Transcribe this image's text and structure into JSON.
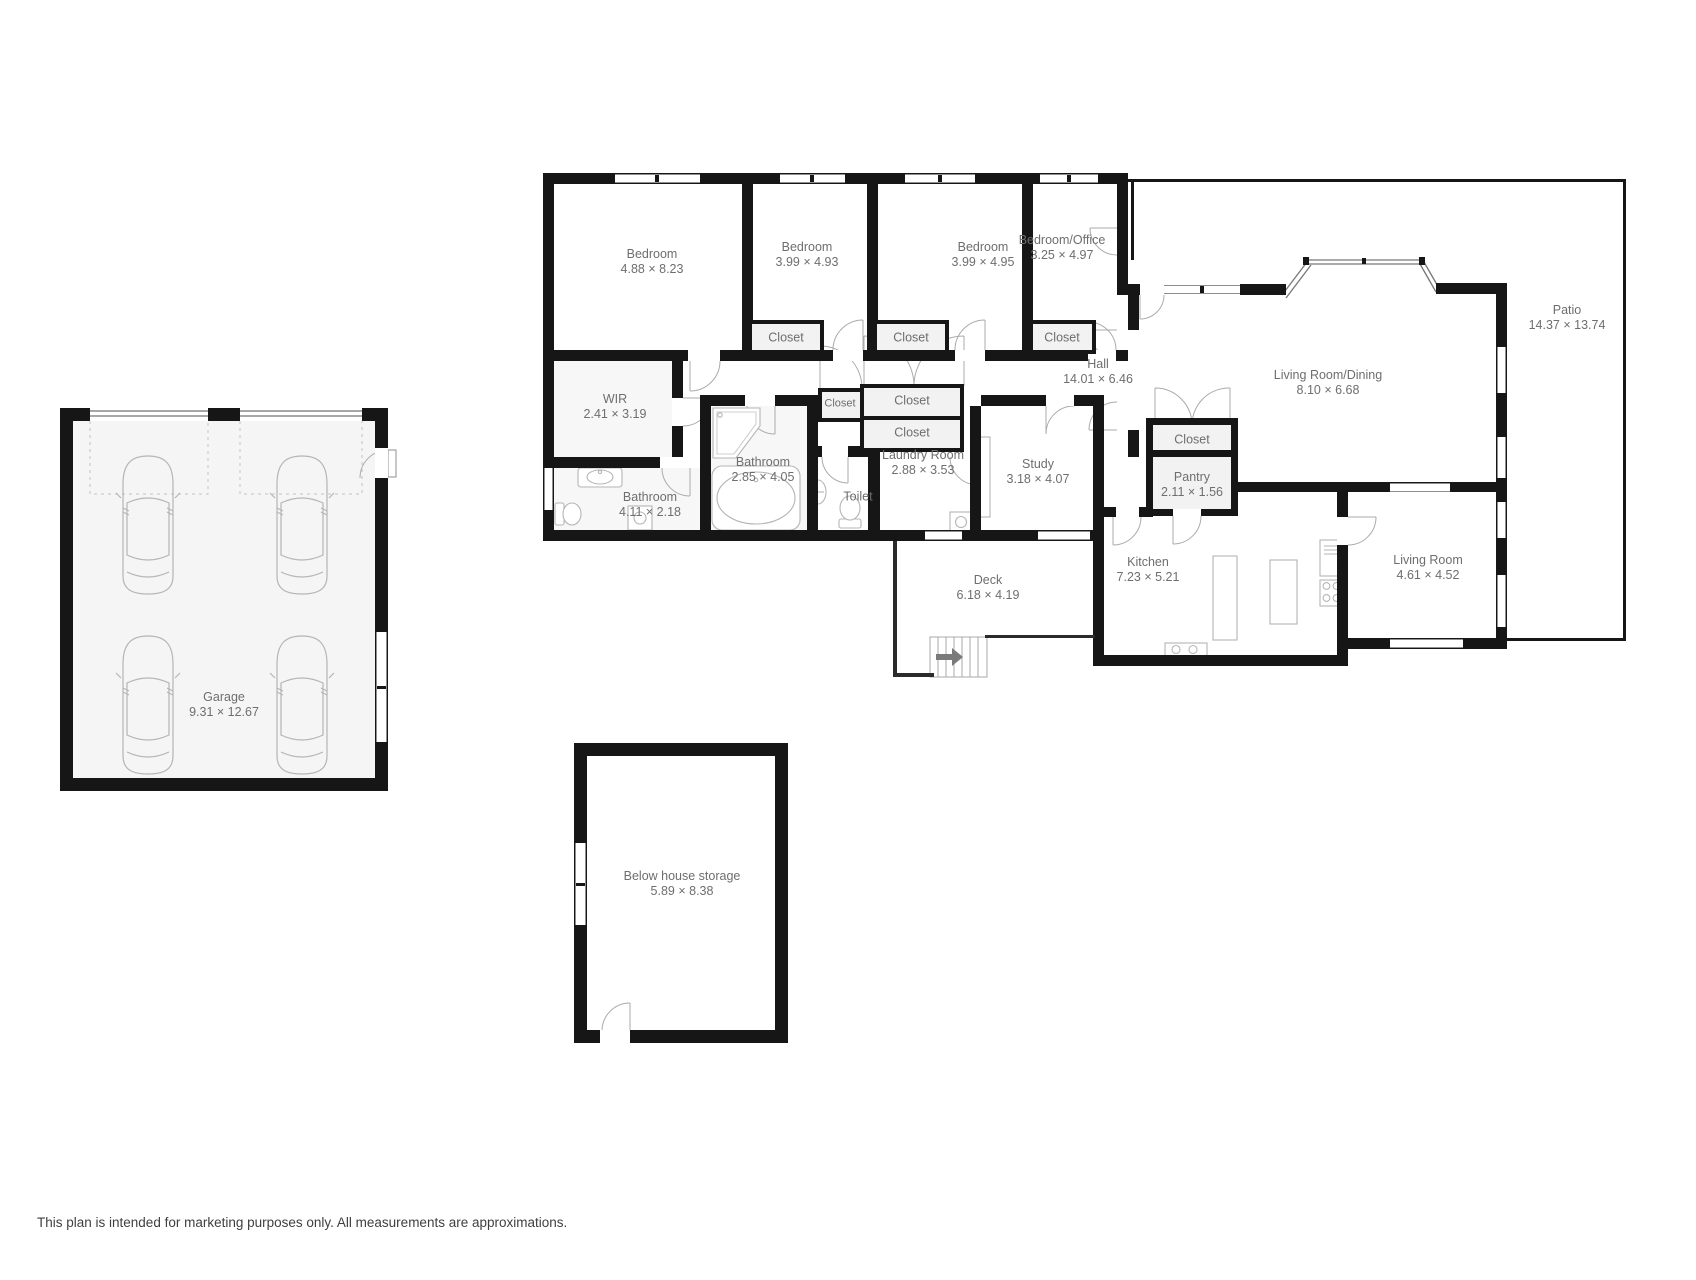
{
  "footer": "This plan is intended for marketing purposes only. All measurements are approximations.",
  "colors": {
    "wall": "#161616",
    "room_fill": "#f5f5f5",
    "label_text": "#6e6e6e",
    "fixture_line": "#b5b5b5"
  },
  "rooms": {
    "garage": {
      "name": "Garage",
      "dims": "9.31 × 12.67"
    },
    "bedroom1": {
      "name": "Bedroom",
      "dims": "4.88 × 8.23"
    },
    "bedroom2": {
      "name": "Bedroom",
      "dims": "3.99 × 4.93"
    },
    "bedroom3": {
      "name": "Bedroom",
      "dims": "3.99 × 4.95"
    },
    "bedroom_office": {
      "name": "Bedroom/Office",
      "dims": "3.25 × 4.97"
    },
    "closet_b2": {
      "name": "Closet"
    },
    "closet_b3": {
      "name": "Closet"
    },
    "closet_b4": {
      "name": "Closet"
    },
    "wir": {
      "name": "WIR",
      "dims": "2.41 × 3.19"
    },
    "hall": {
      "name": "Hall",
      "dims": "14.01 × 6.46"
    },
    "bathroom_main": {
      "name": "Bathroom",
      "dims": "4.11 × 2.18"
    },
    "bathroom_ens": {
      "name": "Bathroom",
      "dims": "2.85 × 4.05"
    },
    "toilet": {
      "name": "Toilet"
    },
    "closet_hall_small": {
      "name": "Closet"
    },
    "closet_hall_upper": {
      "name": "Closet"
    },
    "closet_hall_lower": {
      "name": "Closet"
    },
    "laundry": {
      "name": "Laundry Room",
      "dims": "2.88 × 3.53"
    },
    "study": {
      "name": "Study",
      "dims": "3.18 × 4.07"
    },
    "closet_kitchen": {
      "name": "Closet"
    },
    "pantry": {
      "name": "Pantry",
      "dims": "2.11 × 1.56"
    },
    "living_dining": {
      "name": "Living Room/Dining",
      "dims": "8.10 × 6.68"
    },
    "patio": {
      "name": "Patio",
      "dims": "14.37 × 13.74"
    },
    "kitchen": {
      "name": "Kitchen",
      "dims": "7.23 × 5.21"
    },
    "living_room": {
      "name": "Living Room",
      "dims": "4.61 × 4.52"
    },
    "deck": {
      "name": "Deck",
      "dims": "6.18 × 4.19"
    },
    "storage": {
      "name": "Below house storage",
      "dims": "5.89 × 8.38"
    }
  }
}
